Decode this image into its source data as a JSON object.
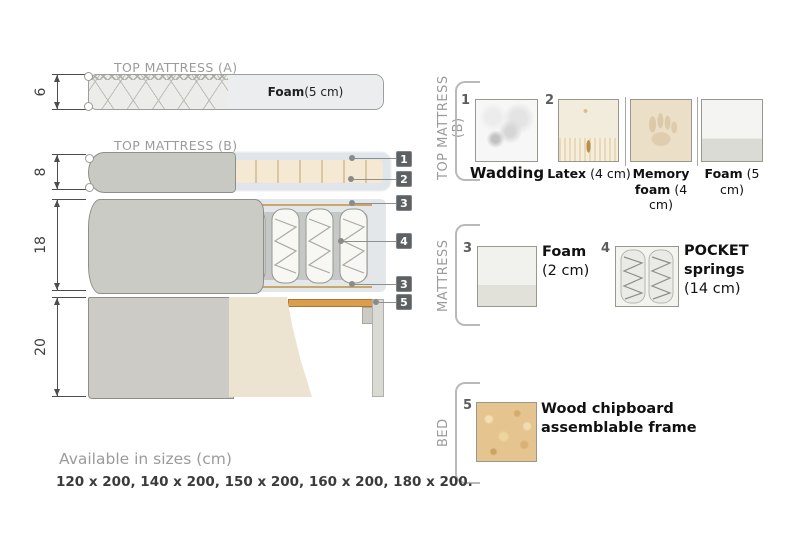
{
  "palette": {
    "fabric_gray": "#cbcbc6",
    "wadding_blue": "#dfe5ea",
    "latex_cream": "#f5e9d4",
    "wood_orange": "#dc9e4d",
    "chipboard_tan": "#e5c48f",
    "badge_gray": "#5e6164",
    "muted_text": "#9b9b9b",
    "dark_text": "#1f1f1f"
  },
  "diagram": {
    "titles": {
      "a": "TOP MATTRESS (A)",
      "b": "TOP MATTRESS (B)"
    },
    "dims": [
      {
        "value": "6"
      },
      {
        "value": "8"
      },
      {
        "value": "18"
      },
      {
        "value": "20"
      }
    ],
    "foam_a": {
      "name": "Foam",
      "detail": " (5 cm)"
    },
    "callouts": [
      {
        "n": "1"
      },
      {
        "n": "2"
      },
      {
        "n": "3"
      },
      {
        "n": "4"
      },
      {
        "n": "3"
      },
      {
        "n": "5"
      }
    ]
  },
  "legend": {
    "groups": [
      {
        "label": "TOP MATTRESS (B)"
      },
      {
        "label": "MATTRESS"
      },
      {
        "label": "BED"
      }
    ],
    "items": {
      "wadding": {
        "num": "1",
        "name": "Wadding",
        "detail": ""
      },
      "latex": {
        "num": "2",
        "name": "Latex",
        "detail": " (4 cm)"
      },
      "memory": {
        "num": "",
        "name": "Memory foam",
        "detail": " (4 cm)"
      },
      "foam5": {
        "num": "",
        "name": "Foam",
        "detail": " (5 cm)"
      },
      "foam2": {
        "num": "3",
        "name": "Foam",
        "detail": "(2 cm)"
      },
      "pocket": {
        "num": "4",
        "name": "POCKET springs",
        "detail": "(14 cm)"
      },
      "wood": {
        "num": "5",
        "name": "Wood chipboard assemblable frame",
        "detail": ""
      }
    }
  },
  "footer": {
    "title": "Available in sizes (cm)",
    "sizes": "120 x 200, 140 x 200, 150 x 200, 160 x 200, 180 x 200."
  }
}
